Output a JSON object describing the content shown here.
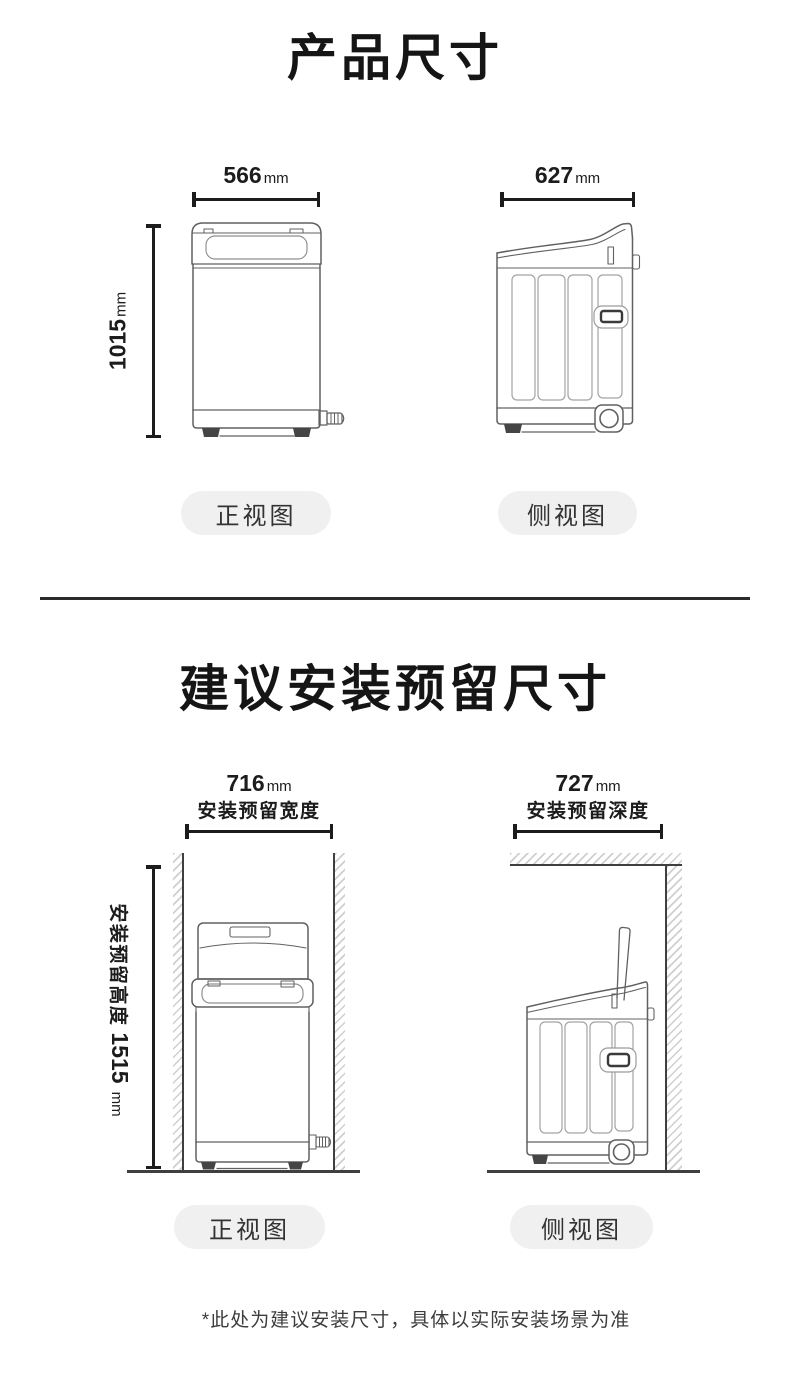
{
  "colors": {
    "ink": "#1c1c1c",
    "line_art": "#606060",
    "wall_line": "#3f3f3f",
    "hatch": "#cfcfcf",
    "pill_bg": "#f0f0f1",
    "pill_text": "#333333"
  },
  "section_product": {
    "title": "产品尺寸",
    "front_width": {
      "num": "566",
      "unit": "mm"
    },
    "side_width": {
      "num": "627",
      "unit": "mm"
    },
    "height": {
      "num": "1015",
      "unit": "mm"
    },
    "front_label": "正视图",
    "side_label": "侧视图"
  },
  "section_install": {
    "title": "建议安装预留尺寸",
    "front_width": {
      "num": "716",
      "unit": "mm",
      "caption": "安装预留宽度"
    },
    "side_width": {
      "num": "727",
      "unit": "mm",
      "caption": "安装预留深度"
    },
    "height": {
      "num": "1515",
      "unit": "mm",
      "caption": "安装预留高度"
    },
    "front_label": "正视图",
    "side_label": "侧视图",
    "footnote": "*此处为建议安装尺寸，具体以实际安装场景为准"
  }
}
